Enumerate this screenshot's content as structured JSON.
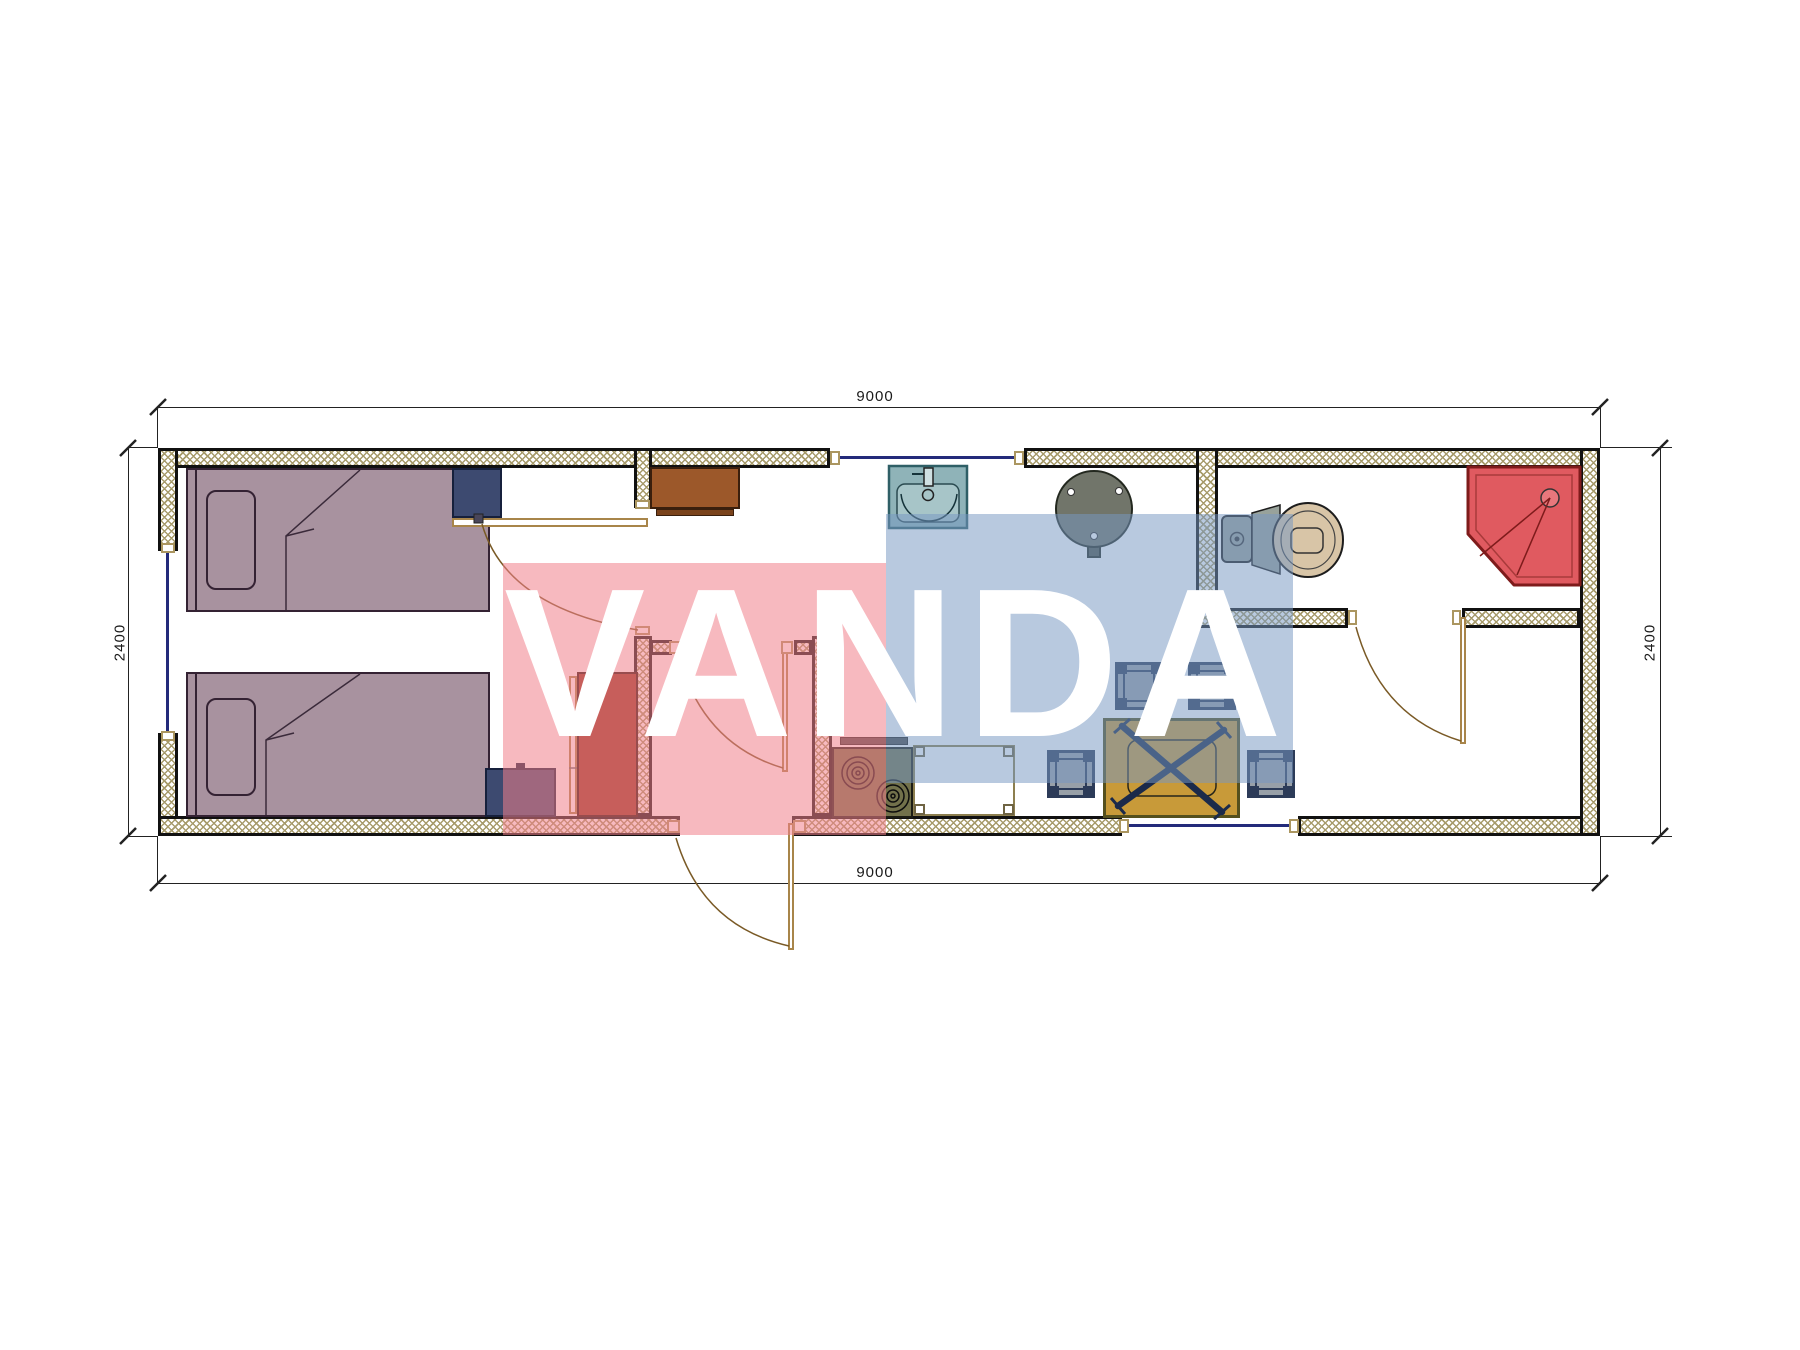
{
  "watermark": {
    "text": "VANDA",
    "pink_block_color": "#f2868e",
    "blue_block_color": "#7d9cc4"
  },
  "dimensions": {
    "top_width": "9000",
    "bottom_width": "9000",
    "left_height": "2400",
    "right_height": "2400"
  },
  "colors": {
    "wall_hatch": "#a79b6b",
    "wall_line": "#111111",
    "bed": "#a8929f",
    "nightstand": "#3d4a70",
    "dresser": "#9c582a",
    "wardrobe": "#963622",
    "sink": "#8fb3b8",
    "round_table": "#71756a",
    "toilet_tank": "#98a29b",
    "toilet_bowl": "#d8c5a7",
    "shower": "#e05a60",
    "stove": "#72714b",
    "dining_table": "#c89a39",
    "stool": "#98a0a8",
    "window_glass": "#232a7a",
    "door_swing": "#7a5a26"
  },
  "fixtures": [
    "bed",
    "pillow",
    "nightstand",
    "closet",
    "dresser",
    "wardrobe",
    "window",
    "entry-door",
    "interior-door",
    "bathroom-door",
    "kitchen-sink",
    "round-table",
    "stove",
    "cooker-hood",
    "counter",
    "stool",
    "dining-table",
    "chair",
    "toilet",
    "shower"
  ]
}
